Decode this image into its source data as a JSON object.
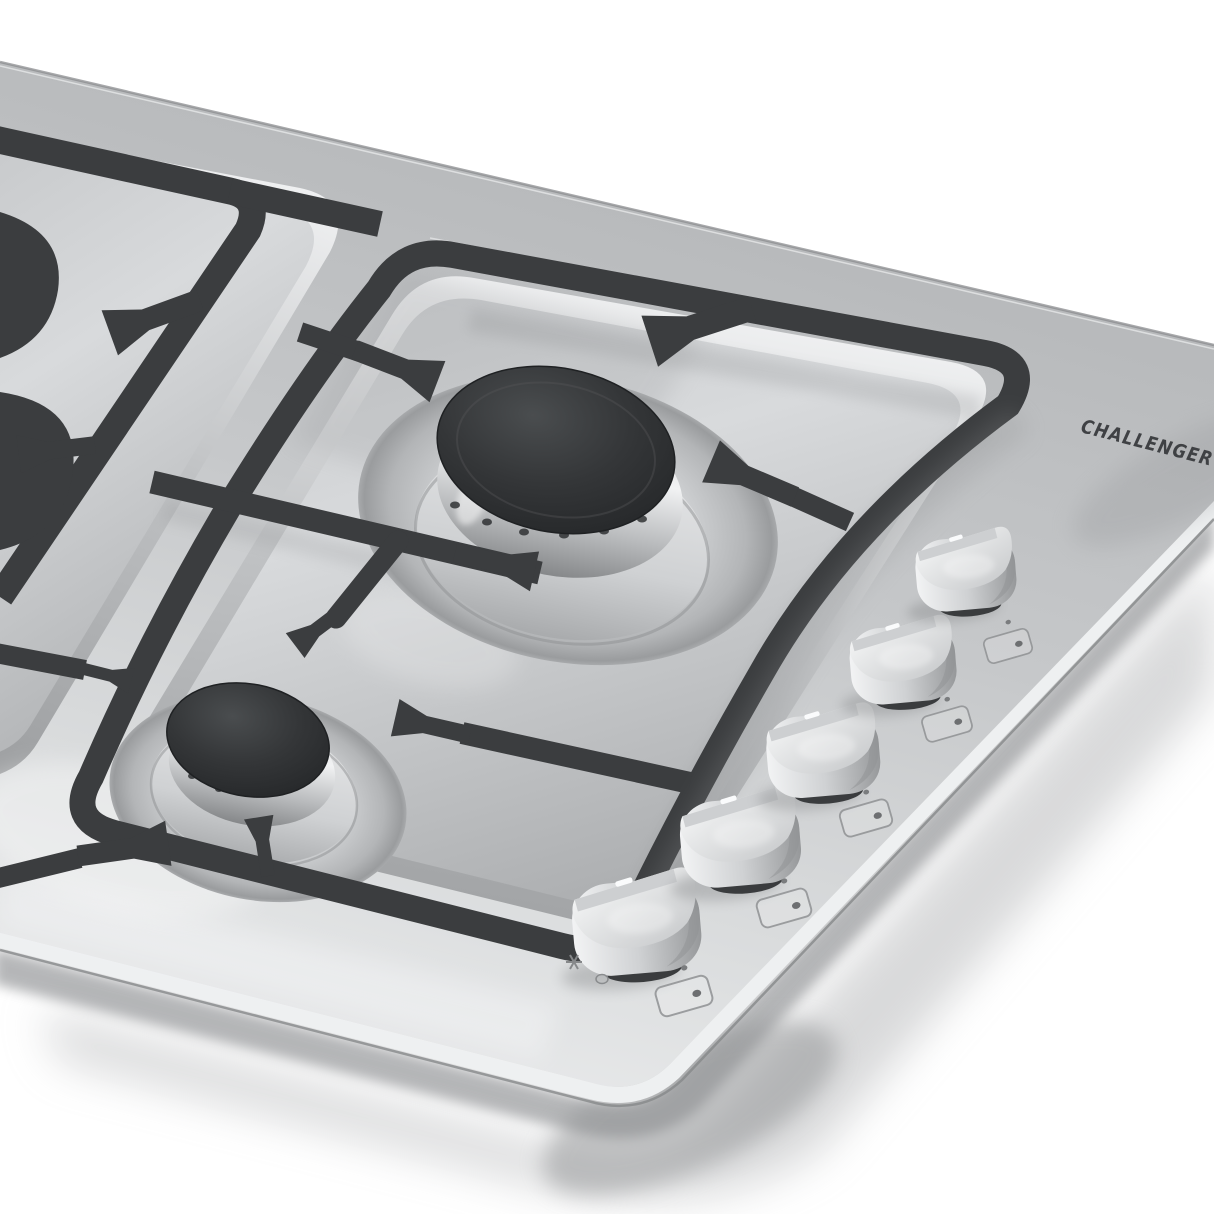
{
  "image": {
    "background_color": "#ffffff",
    "style": "black-and-white product photograph",
    "subject": "Stainless steel built-in gas cooktop seen in perspective, with black cast-iron pan supports, two visible gas burners and five aluminum control knobs on the front-right apron"
  },
  "brand": {
    "logo_text": "CHALLENGER",
    "logo_color": "#3f4144"
  },
  "cooktop": {
    "knob_count": 5,
    "visible_burner_count": 2,
    "icons": [
      "burner-selector-icon",
      "spark-icon",
      "indicator-dot-icon",
      "knob-position-tick"
    ],
    "colors": {
      "panel_light": "#ebecee",
      "panel_mid": "#c6c8ca",
      "panel_dark": "#b2b4b6",
      "well_wall_light": "#f2f3f4",
      "well_floor": "#c9cbcd",
      "grate": "#3b3d3f",
      "burner_cap": "#2e3032",
      "burner_band_light": "#f1f2f3",
      "burner_band_dark": "#87898b",
      "knob_light": "#f5f6f7",
      "knob_dark": "#a3a5a7",
      "shadow": "#9fa1a3"
    }
  }
}
